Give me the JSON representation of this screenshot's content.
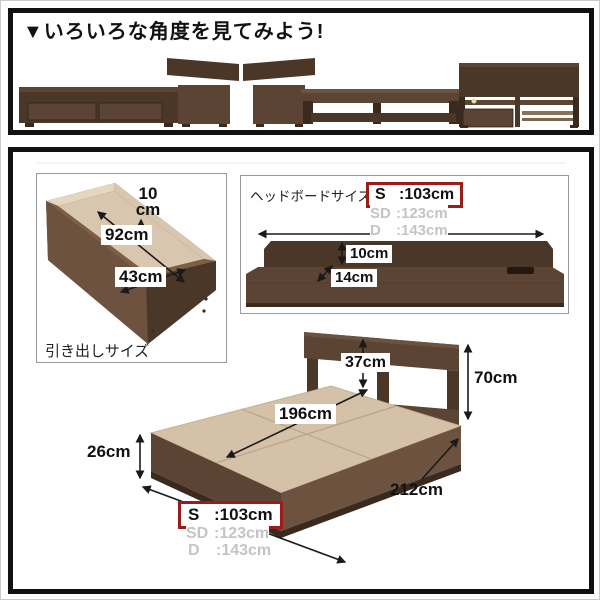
{
  "top_section": {
    "title": "▼いろいろな角度を見てみよう!",
    "views": [
      "bed-side-view-headboard-right",
      "bed-side-view-headboard-left",
      "bed-back-view"
    ]
  },
  "drawer_panel": {
    "caption": "引き出しサイズ",
    "height_value": "10",
    "height_unit": "cm",
    "length": "92cm",
    "width": "43cm"
  },
  "headboard_panel": {
    "title": "ヘッドボードサイズ",
    "sizes": [
      {
        "label": "S",
        "value": ":103cm",
        "highlighted": true
      },
      {
        "label": "SD",
        "value": ":123cm",
        "highlighted": false
      },
      {
        "label": "D",
        "value": ":143cm",
        "highlighted": false
      }
    ],
    "back_height": "10cm",
    "shelf_depth": "14cm"
  },
  "bed_diagram": {
    "shelf_clearance": "37cm",
    "headboard_height": "70cm",
    "inner_length": "196cm",
    "frame_height": "26cm",
    "total_length": "212cm",
    "sizes": [
      {
        "label": "S",
        "value": ":103cm",
        "highlighted": true
      },
      {
        "label": "SD",
        "value": ":123cm",
        "highlighted": false
      },
      {
        "label": "D",
        "value": ":143cm",
        "highlighted": false
      }
    ]
  },
  "colors": {
    "accent_red": "#9c1b1b",
    "gray_text": "#c4c4c4",
    "line_black": "#1a1a1a",
    "border_gray": "#9a9a9a",
    "wood_darkest": "#3a2a1e",
    "wood_dark": "#4b3728",
    "wood_mid": "#5b4433",
    "wood_light": "#6c523f",
    "deck_beige": "#d5c1a7",
    "deck_seam": "#b8a485",
    "interior_beige": "#d8c6ae",
    "interior_light": "#e5d6c0",
    "rim_wood": "#7c5f45"
  }
}
